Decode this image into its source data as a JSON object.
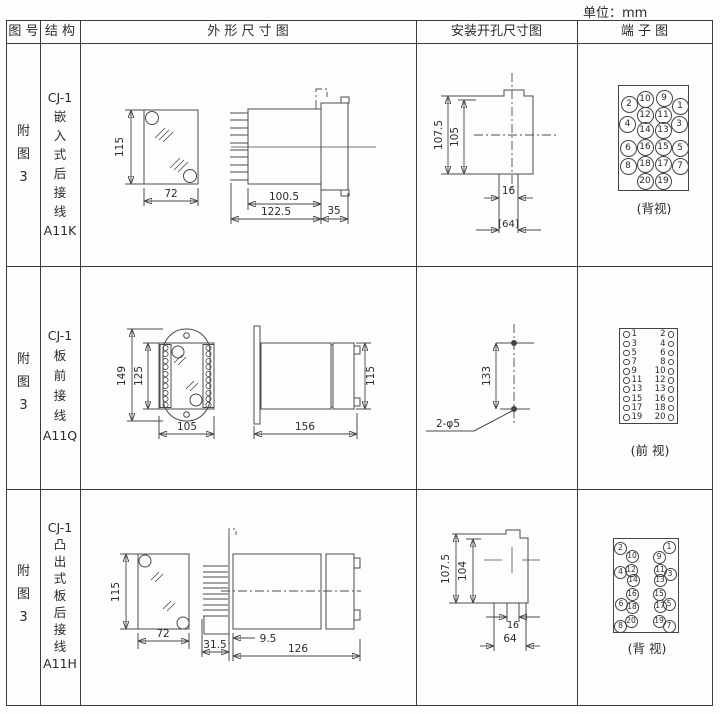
{
  "unit_label": "单位：mm",
  "header": {
    "figure_no": "图 号",
    "structure": "结 构",
    "outline": "外 形 尺 寸 图",
    "mounting": "安装开孔尺寸图",
    "terminal": "端 子 图"
  },
  "rows": [
    {
      "figure_no": "附\n图\n3",
      "structure": "CJ-1\n嵌\n入\n式\n后\n接\n线\nA11K",
      "outline": {
        "front_h": "115",
        "front_w": "72",
        "body_d": "100.5",
        "total_d": "122.5",
        "bezel_d": "35"
      },
      "mounting": {
        "outer_h": "107.5",
        "inner_h": "105",
        "notch_w": "16",
        "cutout_w": "[64]"
      },
      "terminal": {
        "caption": "(背视)",
        "pins": [
          "2",
          "10",
          "9",
          "1",
          "4",
          "12",
          "11",
          "3",
          "14",
          "13",
          "6",
          "16",
          "15",
          "5",
          "8",
          "18",
          "17",
          "7",
          "20",
          "19"
        ]
      }
    },
    {
      "figure_no": "附\n图\n3",
      "structure": "CJ-1\n板\n前\n接\n线\nA11Q",
      "outline": {
        "plate_h": "149",
        "body_h": "125",
        "body_w": "105",
        "depth": "156",
        "side_h": "115"
      },
      "mounting": {
        "span": "133",
        "holes": "2-φ5"
      },
      "terminal": {
        "caption": "(前 视)",
        "left": [
          "1",
          "3",
          "5",
          "7",
          "9",
          "11",
          "13",
          "15",
          "17",
          "19"
        ],
        "right": [
          "2",
          "4",
          "6",
          "8",
          "10",
          "12",
          "13",
          "16",
          "18",
          "20"
        ]
      }
    },
    {
      "figure_no": "附\n图\n3",
      "structure": "CJ-1\n凸\n出\n式\n板\n后\n接\n线\nA11H",
      "outline": {
        "front_h": "115",
        "front_w": "72",
        "pin_d": "31.5",
        "gap": "9.5",
        "body_d": "126"
      },
      "mounting": {
        "outer_h": "107.5",
        "inner_h": "104",
        "notch_w": "16",
        "cutout_w": "64"
      },
      "terminal": {
        "caption": "(背 视)",
        "pins": [
          "2",
          "1",
          "10",
          "9",
          "4",
          "12",
          "11",
          "3",
          "14",
          "13",
          "16",
          "15",
          "6",
          "18",
          "17",
          "5",
          "20",
          "19",
          "8",
          "7"
        ]
      }
    }
  ]
}
